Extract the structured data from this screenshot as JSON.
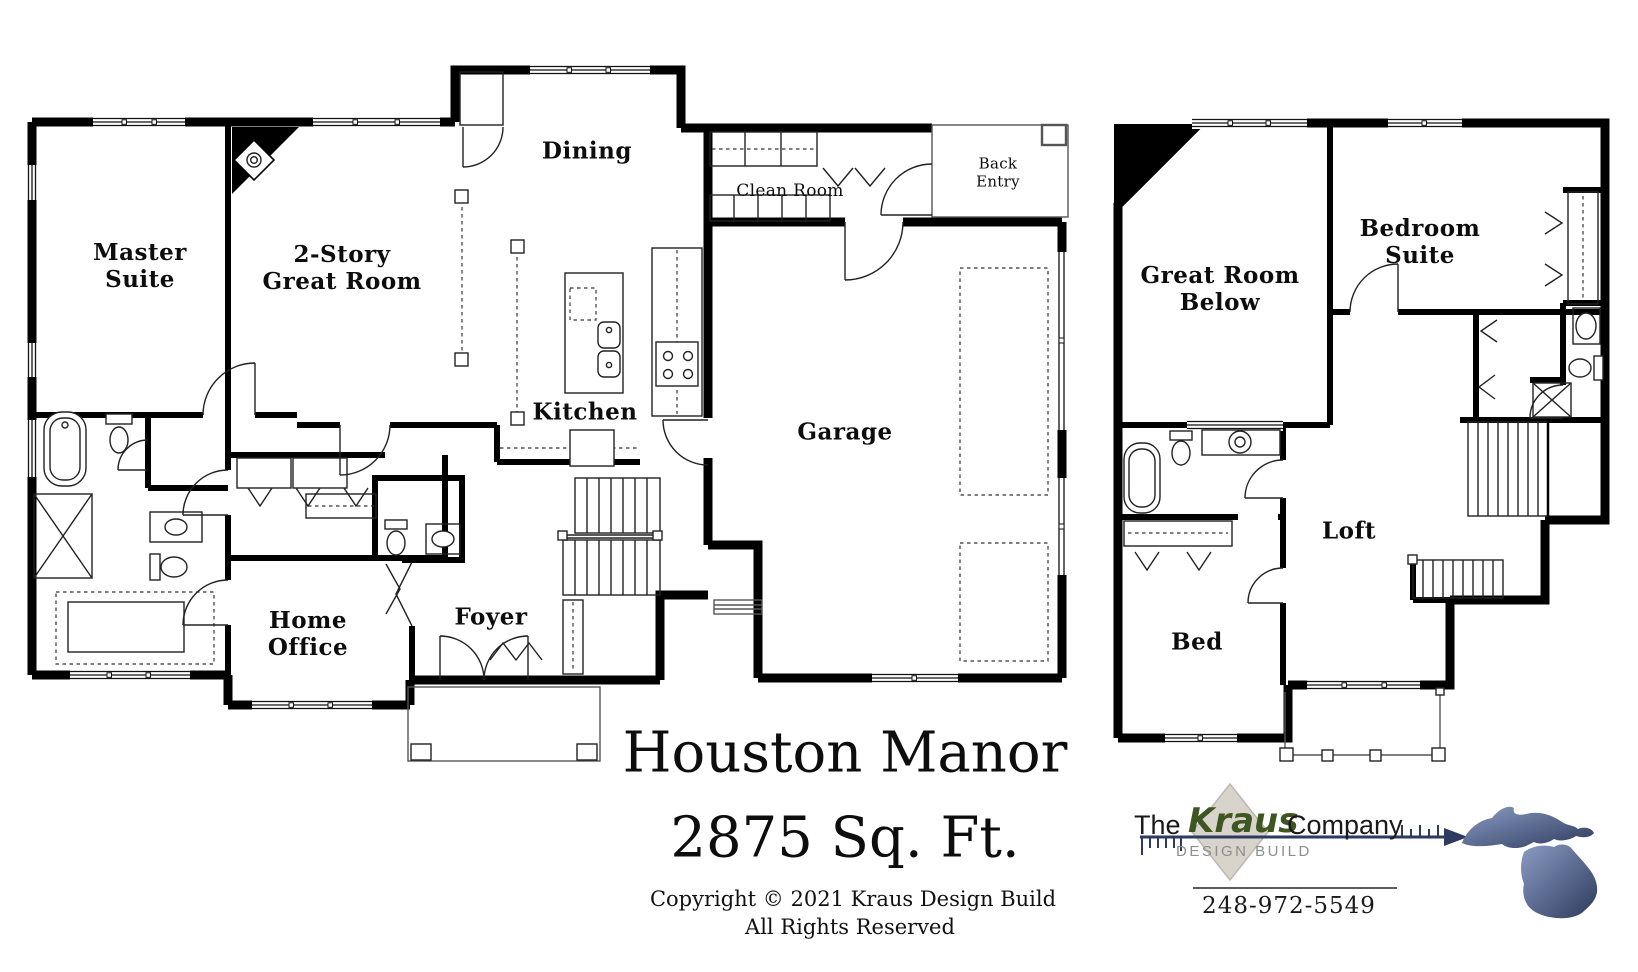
{
  "header": {
    "plan_name": "Houston Manor",
    "square_footage": "2875 Sq. Ft."
  },
  "footer": {
    "copyright": "Copyright © 2021 Kraus Design Build",
    "rights": "All Rights Reserved"
  },
  "first_floor": {
    "rooms": {
      "master_suite": "Master\nSuite",
      "great_room": "2-Story\nGreat Room",
      "dining": "Dining",
      "clean_room": "Clean Room",
      "back_entry": "Back\nEntry",
      "kitchen": "Kitchen",
      "garage": "Garage",
      "home_office": "Home\nOffice",
      "foyer": "Foyer"
    }
  },
  "second_floor": {
    "rooms": {
      "great_room_below": "Great Room\nBelow",
      "bedroom_suite": "Bedroom\nSuite",
      "loft": "Loft",
      "bed": "Bed"
    }
  },
  "logo": {
    "prefix": "The",
    "brand": "Kraus",
    "suffix": "Company",
    "tagline": "DESIGN BUILD",
    "phone": "248-972-5549"
  },
  "colors": {
    "wall": "#000000",
    "brand_green": "#3e5622",
    "diamond": "#d8d4cb",
    "arrow_navy": "#2e3a5f",
    "michigan_light": "#8b9cc4",
    "michigan_dark": "#2c3a5c",
    "tagline_gray": "#8d8d8d"
  }
}
